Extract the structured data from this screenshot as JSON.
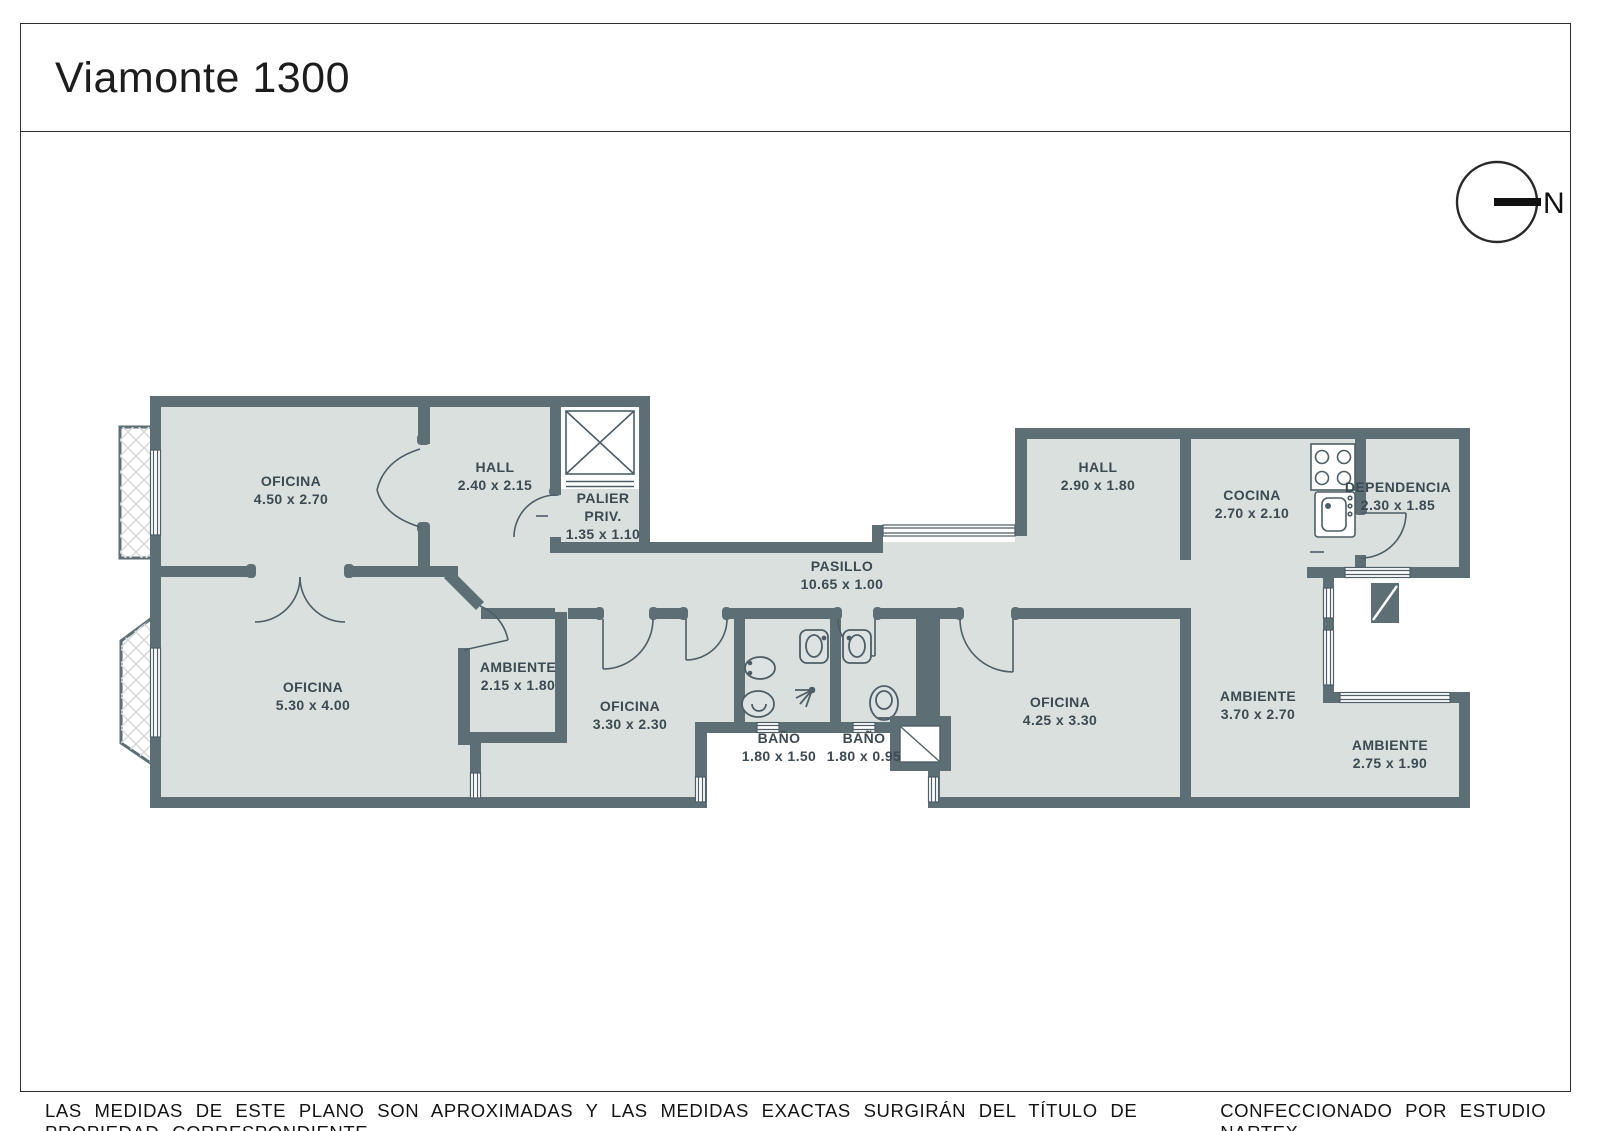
{
  "title": "Viamonte 1300",
  "north_label": "N",
  "rooms": [
    {
      "id": "oficina-a",
      "name": "OFICINA",
      "dims": "4.50 x 2.70"
    },
    {
      "id": "hall-a",
      "name": "HALL",
      "dims": "2.40 x 2.15"
    },
    {
      "id": "palier-priv",
      "name": "PALIER",
      "line2": "PRIV.",
      "dims": "1.35 x 1.10"
    },
    {
      "id": "oficina-b",
      "name": "OFICINA",
      "dims": "5.30 x 4.00"
    },
    {
      "id": "ambiente-a",
      "name": "AMBIENTE",
      "dims": "2.15 x 1.80"
    },
    {
      "id": "oficina-c",
      "name": "OFICINA",
      "dims": "3.30 x 2.30"
    },
    {
      "id": "bano-a",
      "name": "BAÑO",
      "dims": "1.80 x 1.50"
    },
    {
      "id": "bano-b",
      "name": "BAÑO",
      "dims": "1.80 x 0.95"
    },
    {
      "id": "pasillo",
      "name": "PASILLO",
      "dims": "10.65 x 1.00"
    },
    {
      "id": "hall-b",
      "name": "HALL",
      "dims": "2.90 x 1.80"
    },
    {
      "id": "cocina",
      "name": "COCINA",
      "dims": "2.70 x 2.10"
    },
    {
      "id": "dependencia",
      "name": "DEPENDENCIA",
      "dims": "2.30 x 1.85"
    },
    {
      "id": "oficina-d",
      "name": "OFICINA",
      "dims": "4.25 x 3.30"
    },
    {
      "id": "ambiente-b",
      "name": "AMBIENTE",
      "dims": "3.70 x 2.70"
    },
    {
      "id": "ambiente-c",
      "name": "AMBIENTE",
      "dims": "2.75 x 1.90"
    }
  ],
  "footer": {
    "disclaimer": "LAS MEDIDAS DE ESTE PLANO SON APROXIMADAS Y LAS MEDIDAS EXACTAS SURGIRÁN DEL TÍTULO DE PROPIEDAD CORRESPONDIENTE.",
    "credit": "CONFECCIONADO POR ESTUDIO NARTEX"
  },
  "colors": {
    "wall": "#5d6e75",
    "floor": "#d9e0de",
    "line": "#4e5e66",
    "hatch": "#d7dada"
  }
}
